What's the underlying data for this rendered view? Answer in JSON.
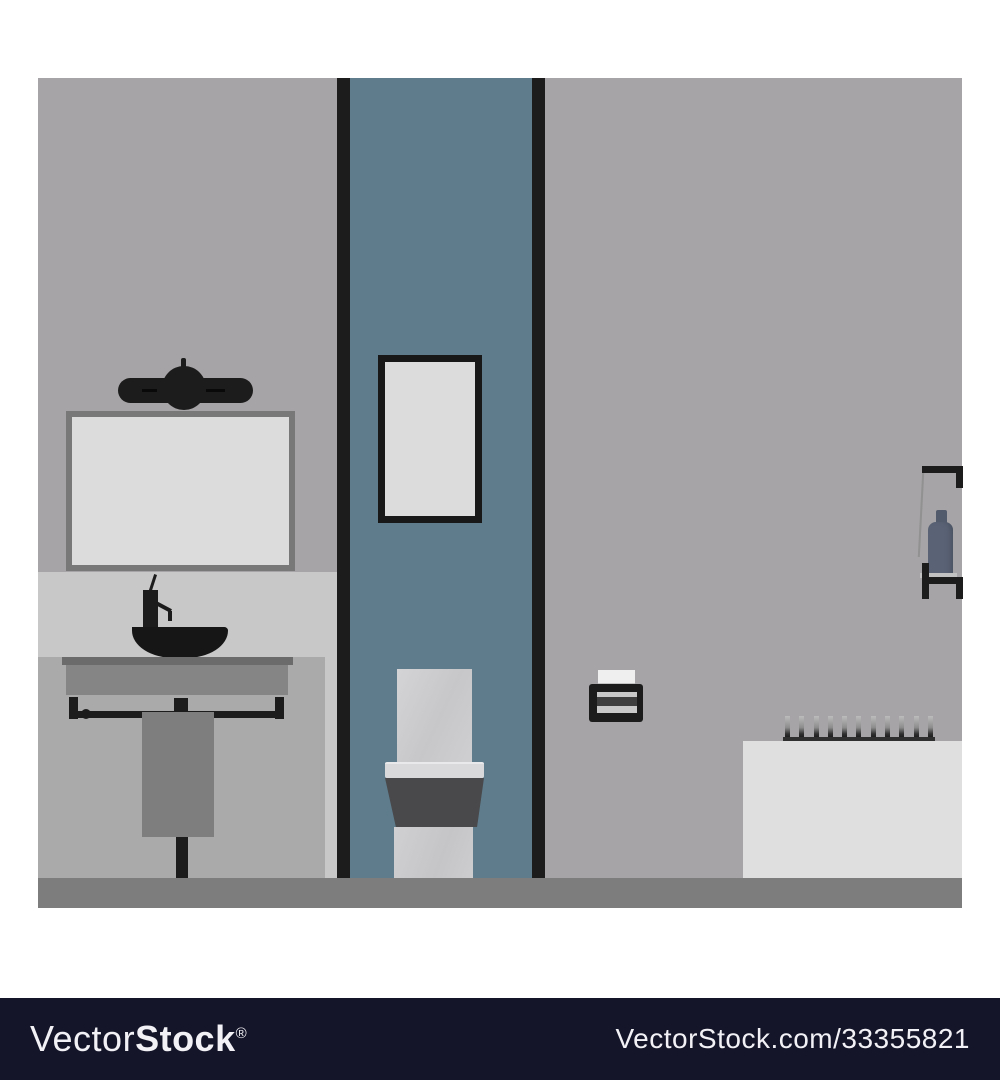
{
  "watermark": {
    "bar_color": "#15152a",
    "text_color": "#f2f2f6",
    "logo_light": "Vector",
    "logo_bold": "Stock",
    "logo_registered": "®",
    "image_id_text": "VectorStock.com/33355821"
  },
  "illustration": {
    "shelf_bottle_count": 11,
    "palette": {
      "wall": "#a6a4a6",
      "backsplash_band": "#c9c8c9",
      "door_panel_blue": "#5e7c8c",
      "panel_border_black": "#1d1c1c",
      "mirror_frame": "#787878",
      "mirror_glass": "#dcdcdc",
      "picture_mat": "#dcdcdc",
      "counter": "#858585",
      "towel": "#7e7e7e",
      "floor": "#7d7d7d",
      "bathtub": "#dfdfdf",
      "toilet_light": "#cdcdcf",
      "toilet_bowl_dark": "#49494b",
      "hanging_bottle_blue": "#5a6375",
      "fixture_black": "#161616"
    }
  }
}
